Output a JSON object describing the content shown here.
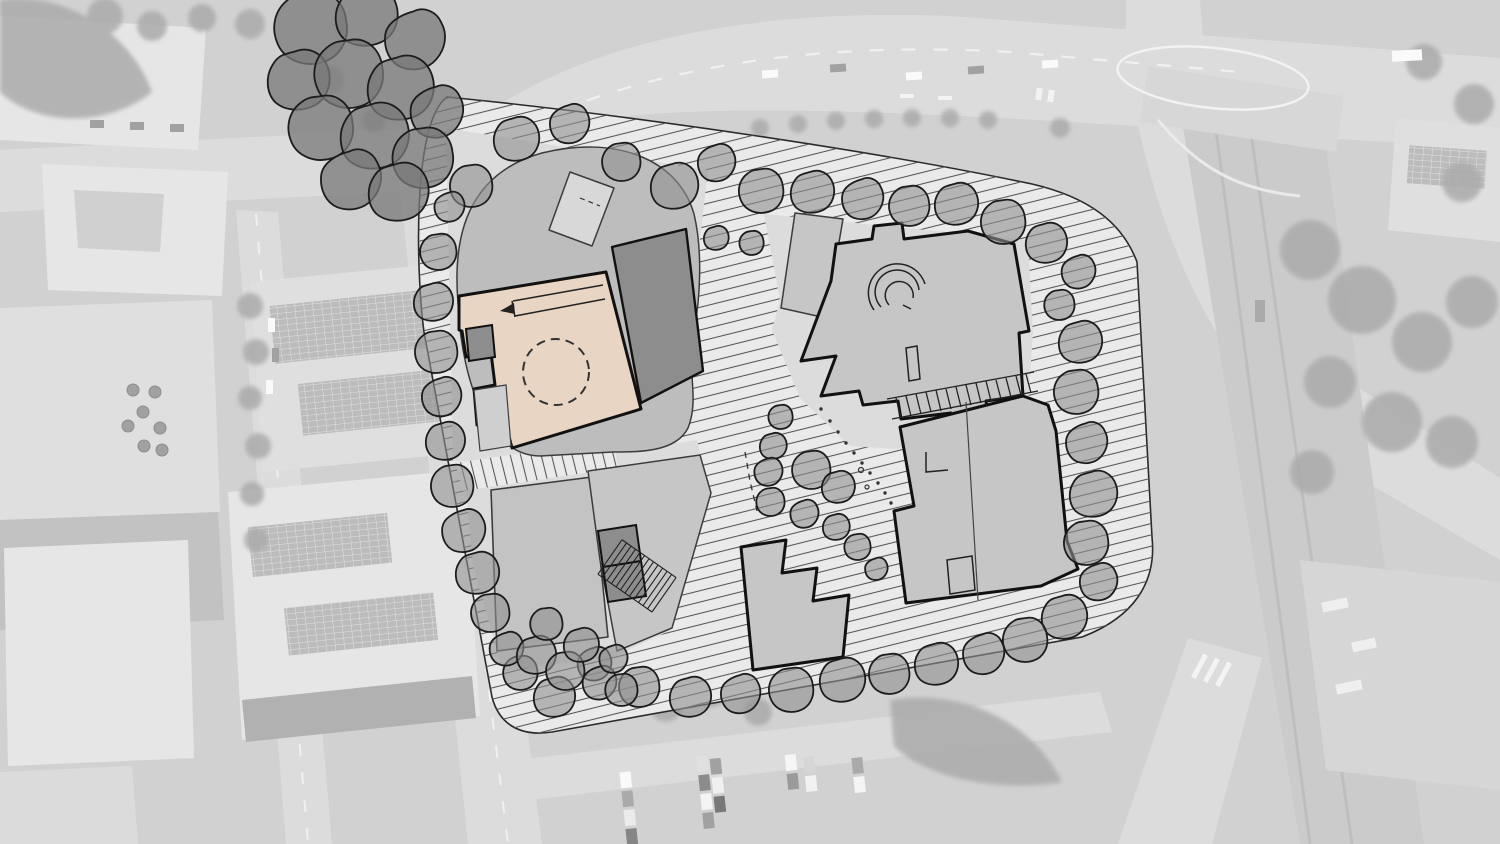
{
  "scene": {
    "type": "architectural-masterplan-site-plan-over-aerial-photo",
    "features": [
      "aerial-photo-background",
      "road-bridge",
      "canal-corridor",
      "parking-lot",
      "solar-roof-buildings",
      "existing-tree-cluster",
      "site-boundary",
      "perimeter-landscape-hatch",
      "central-walkway-hatch",
      "existing-blob-building",
      "highlighted-building",
      "courtyard-dashed-circle",
      "ramp-arrow",
      "dark-roof-building",
      "north-east-building",
      "curved-stair-feature",
      "south-east-building",
      "stair-symbol",
      "perimeter-trees",
      "courtyard-trees",
      "dotted-path"
    ]
  },
  "palette": {
    "aerial_base": "#c9c9c9",
    "aerial_road": "#d6d6d6",
    "aerial_road_dark": "#c2c2c2",
    "aerial_building_light": "#e2e2e2",
    "aerial_building_mid": "#d9d9d9",
    "aerial_building_dark": "#a2a2a2",
    "aerial_tree": "#9b9b9b",
    "aerial_marking": "#f1f1f1",
    "wash": "rgba(255,255,255,0.16)",
    "site_ground": "#eaeaea",
    "site_plot": "#dcdcdc",
    "hatch_line": "#555555",
    "building_fill": "#c6c6c6",
    "building_fill_alt": "#bdbdbd",
    "building_dark": "#8d8d8d",
    "building_outline": "#111111",
    "building_outline_thin": "#3c3c3c",
    "highlight_fill": "#e9d5c3",
    "highlight_annex": "#cfcfcf",
    "tree_fill": "rgba(143,143,143,0.6)",
    "tree_ext_fill": "rgba(120,120,120,0.75)",
    "tree_outline": "#1c1c1c",
    "boundary_line": "#2a2a2a",
    "panel_dark": "#b0b0b0"
  }
}
